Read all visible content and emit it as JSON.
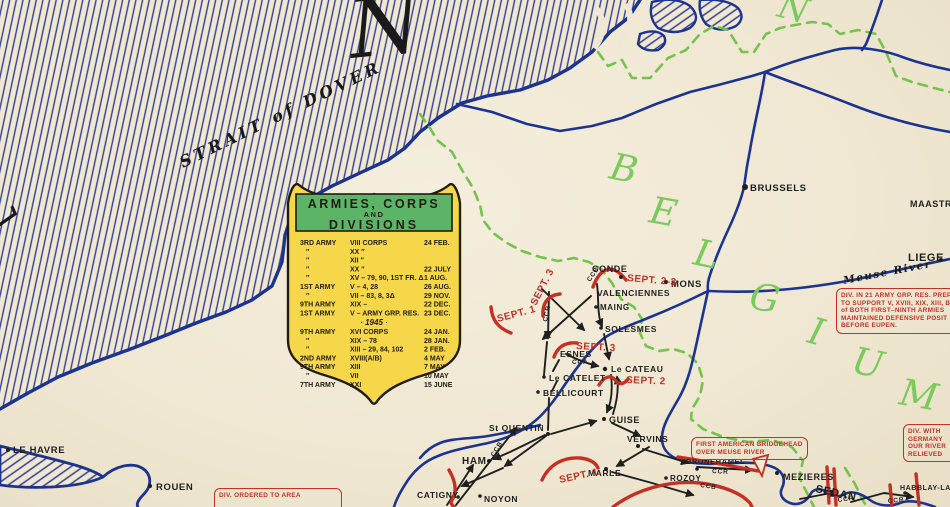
{
  "colors": {
    "paper": "#f0e8d3",
    "coast": "#1c3490",
    "hatch": "#33408e",
    "green_border": "#74c34c",
    "green_letter": "#7cc95e",
    "red": "#c43023",
    "legend_yellow": "#f6d74a",
    "legend_green": "#5cb567",
    "ink": "#1f1f1f"
  },
  "sea": {
    "channel_letter": "L",
    "strait_label": "STRAIT of DOVER",
    "title_letter": "N"
  },
  "regions": {
    "belgium": [
      "B",
      "E",
      "L",
      "G",
      "I",
      "U",
      "M"
    ],
    "north_partial": "N"
  },
  "river_label": "Meuse River",
  "legend": {
    "title1": "ARMIES, CORPS",
    "title2": "AND",
    "title3": "DIVISIONS",
    "year": "· 1945 ·",
    "rows": [
      {
        "a": "3RD ARMY",
        "c": "VIII CORPS",
        "d": "24 FEB."
      },
      {
        "a": "″",
        "c": "XX   ″",
        "d": ""
      },
      {
        "a": "″",
        "c": "XII   ″",
        "d": ""
      },
      {
        "a": "″",
        "c": "XX   ″",
        "d": "22 JULY"
      },
      {
        "a": "″",
        "c": "XV – 79, 90, 1ST FR. Δ",
        "d": "1 AUG."
      },
      {
        "a": "1ST ARMY",
        "c": "V – 4, 28",
        "d": "26 AUG."
      },
      {
        "a": "″",
        "c": "VII – 83, 8, 3Δ",
        "d": "29 NOV."
      },
      {
        "a": "9TH ARMY",
        "c": "XIX –",
        "d": "22 DEC."
      },
      {
        "a": "1ST ARMY",
        "c": "V – ARMY GRP. RES.",
        "d": "23 DEC."
      },
      {
        "a": "9TH ARMY",
        "c": "XVI CORPS",
        "d": "24 JAN."
      },
      {
        "a": "″",
        "c": "XIX – 78",
        "d": "28 JAN."
      },
      {
        "a": "″",
        "c": "XIII – 29, 84, 102",
        "d": "2 FEB."
      },
      {
        "a": "2ND ARMY",
        "c": "XVIII(A/B)",
        "d": "4 MAY"
      },
      {
        "a": "9TH ARMY",
        "c": "XIII",
        "d": "7 MAY"
      },
      {
        "a": "″",
        "c": "VII",
        "d": "10 MAY"
      },
      {
        "a": "7TH ARMY",
        "c": "XXI",
        "d": "15 JUNE"
      }
    ]
  },
  "places": {
    "le_havre": "LE HAVRE",
    "rouen": "ROUEN",
    "catigny": "CATIGNY",
    "noyon": "NOYON",
    "ham": "HAM",
    "st_quentin": "St QUENTIN",
    "bellicourt": "BELLICOURT",
    "le_catelet": "Le CATELET",
    "esnes": "ESNES",
    "le_cateau": "Le CATEAU",
    "guise": "GUISE",
    "vervins": "VERVINS",
    "marle": "MARLE",
    "rozoy": "ROZOY",
    "brunehamel": "BRUNEHAMEL",
    "mezieres": "MEZIERES",
    "sedan": "SEDAN",
    "habblay": "HABBLAY-LA",
    "conde": "CONDE",
    "mons": "MONS",
    "valenciennes": "VALENCIENNES",
    "maing": "MAING",
    "solesmes": "SOLESMES",
    "brussels": "BRUSSELS",
    "maastricht": "MAASTRICHT",
    "liege": "LIEGE."
  },
  "sept": [
    "SEPT. 2-3",
    "SEPT. 3",
    "SEPT. 1",
    "SEPT. 3",
    "SEPT. 2",
    "SEPT. 1"
  ],
  "units": [
    "CCB",
    "CCR",
    "CCA",
    "CCB",
    "CCB",
    "CCR",
    "CCR",
    "CCR"
  ],
  "callouts": {
    "army_grp": [
      "DIV. IN 21 ARMY GRP. RES. PREP",
      "TO SUPPORT V, XVIII, XIX, XIII, BR",
      "of BOTH FIRST–NINTH ARMIES",
      "MAINTAINED DEFENSIVE POSIT",
      "BEFORE EUPEN."
    ],
    "germany": [
      "DIV. WITH",
      "GERMANY",
      "OUR RIVER",
      "RELIEVED"
    ],
    "bridgehead": [
      "FIRST AMERICAN BRIDGEHEAD",
      "OVER MEUSE RIVER"
    ],
    "ordered": [
      "DIV. ORDERED TO AREA"
    ]
  }
}
